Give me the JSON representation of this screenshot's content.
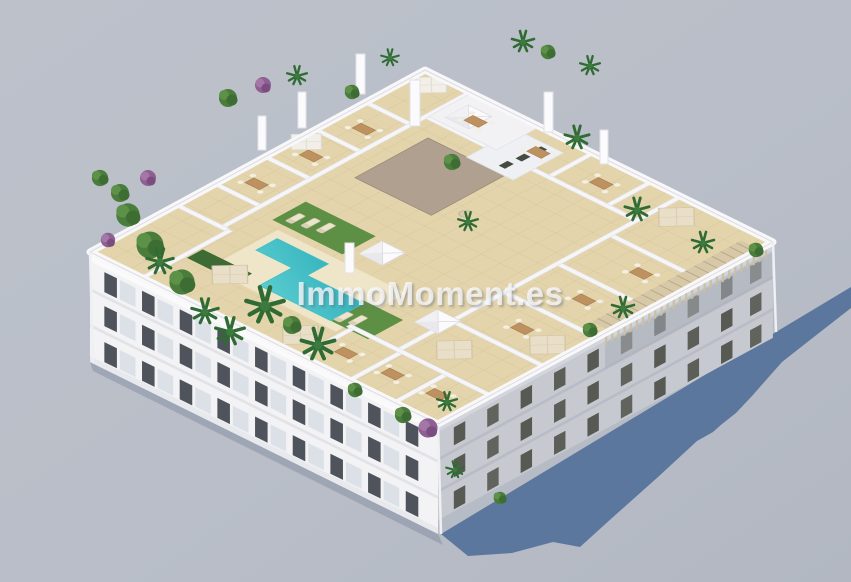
{
  "watermark": {
    "text": "ImmoMoment.es"
  },
  "scene": {
    "description": "Aerial 3D render of a white apartment building with landscaped rooftop terraces, pool, lawns, parasols and palm trees",
    "colors": {
      "background": "#b9bec8",
      "ground_shadow": "#54719a",
      "facade_sunlit": "#f3f3f5",
      "facade_shaded": "#c6c9d0",
      "roof_tiles": "#e3d4ab",
      "pool_deck": "#efe6c9",
      "pool_water": "#3fc0c6",
      "lawn": "#5d8f45",
      "hedge": "#3e6b33",
      "core_roof": "#b0a090",
      "parapet_wall": "#f7f7f9",
      "pergola_wood": "#d6c8a8",
      "umbrella_canvas": "#e9dfc8",
      "palm_foliage": "#2f6b33",
      "window_glass": "#4f545c",
      "watermark_text": "#fafafc"
    }
  }
}
